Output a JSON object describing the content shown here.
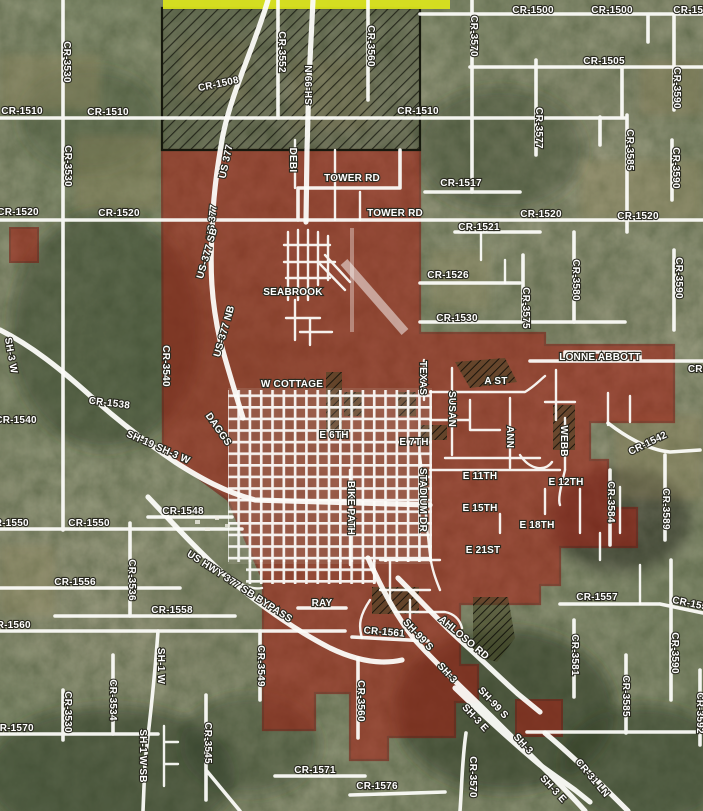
{
  "map": {
    "colors": {
      "road": "#fdfdfa",
      "city_fill": "#a51a10",
      "city_border": "#7c130c",
      "hatch": "#16180d",
      "annex_yellow": "#d9e31d",
      "label_fill": "#ffffff",
      "label_halo": "#2a2a20"
    },
    "road_labels": [
      {
        "text": "CR-1500",
        "x": 533,
        "y": 13
      },
      {
        "text": "CR-1500",
        "x": 612,
        "y": 13
      },
      {
        "text": "CR-1500",
        "x": 694,
        "y": 13
      },
      {
        "text": "CR-1505",
        "x": 604,
        "y": 64
      },
      {
        "text": "CR-1510",
        "x": 22,
        "y": 114
      },
      {
        "text": "CR-1510",
        "x": 108,
        "y": 115
      },
      {
        "text": "CR-1510",
        "x": 418,
        "y": 114
      },
      {
        "text": "CR-1508",
        "x": 219,
        "y": 87,
        "r": -12
      },
      {
        "text": "CR-3530",
        "x": 64,
        "y": 62,
        "r": 90
      },
      {
        "text": "CR-3530",
        "x": 65,
        "y": 166,
        "r": 90
      },
      {
        "text": "CR-3552",
        "x": 279,
        "y": 52,
        "r": 90
      },
      {
        "text": "SH-99 N",
        "x": 312,
        "y": 85,
        "r": -90
      },
      {
        "text": "US 377",
        "x": 229,
        "y": 162,
        "r": -78
      },
      {
        "text": "US 377",
        "x": 215,
        "y": 222,
        "r": -84
      },
      {
        "text": "DEBI",
        "x": 290,
        "y": 160,
        "r": 90
      },
      {
        "text": "CR-3560",
        "x": 368,
        "y": 46,
        "r": 90
      },
      {
        "text": "CR-3570",
        "x": 471,
        "y": 36,
        "r": 90
      },
      {
        "text": "CR-3577",
        "x": 536,
        "y": 128,
        "r": 90
      },
      {
        "text": "CR-3585",
        "x": 627,
        "y": 150,
        "r": 90
      },
      {
        "text": "CR-3590",
        "x": 674,
        "y": 88,
        "r": 90
      },
      {
        "text": "CR-3590",
        "x": 673,
        "y": 168,
        "r": 90
      },
      {
        "text": "CR-1517",
        "x": 461,
        "y": 186
      },
      {
        "text": "TOWER RD",
        "x": 352,
        "y": 181
      },
      {
        "text": "TOWER RD",
        "x": 395,
        "y": 216
      },
      {
        "text": "CR-1520",
        "x": 18,
        "y": 215
      },
      {
        "text": "CR-1520",
        "x": 119,
        "y": 216
      },
      {
        "text": "CR-1520",
        "x": 541,
        "y": 217
      },
      {
        "text": "CR-1520",
        "x": 638,
        "y": 219
      },
      {
        "text": "CR-1521",
        "x": 479,
        "y": 230
      },
      {
        "text": "CR-1526",
        "x": 448,
        "y": 278
      },
      {
        "text": "CR-1530",
        "x": 457,
        "y": 321
      },
      {
        "text": "CR-3575",
        "x": 523,
        "y": 308,
        "r": 90
      },
      {
        "text": "CR-3580",
        "x": 573,
        "y": 280,
        "r": 90
      },
      {
        "text": "CR-3590",
        "x": 676,
        "y": 278,
        "r": 90
      },
      {
        "text": "US-377 SB",
        "x": 210,
        "y": 254,
        "r": -74
      },
      {
        "text": "US-377 NB",
        "x": 227,
        "y": 332,
        "r": -74
      },
      {
        "text": "SEABROOK",
        "x": 293,
        "y": 295,
        "s": 10.5
      },
      {
        "text": "SH-3 W",
        "x": 8,
        "y": 356,
        "r": 80
      },
      {
        "text": "CR-3540",
        "x": 163,
        "y": 366,
        "r": 90
      },
      {
        "text": "CR-1538",
        "x": 109,
        "y": 406,
        "r": 7
      },
      {
        "text": "CR-1540",
        "x": 16,
        "y": 423
      },
      {
        "text": "SH-19 SH-3 W",
        "x": 157,
        "y": 450,
        "r": 24
      },
      {
        "text": "DAGGS",
        "x": 216,
        "y": 431,
        "r": 55
      },
      {
        "text": "W COTTAGE",
        "x": 292,
        "y": 387
      },
      {
        "text": "LONNE ABBOTT",
        "x": 600,
        "y": 360,
        "s": 10.5
      },
      {
        "text": "CR-",
        "x": 697,
        "y": 372
      },
      {
        "text": "TEXAS",
        "x": 420,
        "y": 378,
        "r": 90
      },
      {
        "text": "SUSAN",
        "x": 449,
        "y": 409,
        "r": 90
      },
      {
        "text": "A ST",
        "x": 496,
        "y": 384
      },
      {
        "text": "ANN",
        "x": 507,
        "y": 437,
        "r": 90
      },
      {
        "text": "WEBB",
        "x": 561,
        "y": 441,
        "r": 90
      },
      {
        "text": "E 6TH",
        "x": 334,
        "y": 438
      },
      {
        "text": "E 7TH",
        "x": 414,
        "y": 445
      },
      {
        "text": "BIKE PATH",
        "x": 348,
        "y": 508,
        "r": 90
      },
      {
        "text": "STADIUM DR",
        "x": 420,
        "y": 500,
        "r": 90
      },
      {
        "text": "E 11TH",
        "x": 480,
        "y": 479
      },
      {
        "text": "E 12TH",
        "x": 566,
        "y": 485
      },
      {
        "text": "E 15TH",
        "x": 480,
        "y": 511
      },
      {
        "text": "E 18TH",
        "x": 537,
        "y": 528
      },
      {
        "text": "E 21ST",
        "x": 483,
        "y": 553
      },
      {
        "text": "CR-1542",
        "x": 649,
        "y": 446,
        "r": -26
      },
      {
        "text": "CR-3584",
        "x": 608,
        "y": 502,
        "r": 90
      },
      {
        "text": "CR-3589",
        "x": 663,
        "y": 509,
        "r": 90
      },
      {
        "text": "CR-1557",
        "x": 597,
        "y": 600
      },
      {
        "text": "CR-1557",
        "x": 692,
        "y": 607,
        "r": 12
      },
      {
        "text": "RAY",
        "x": 322,
        "y": 606
      },
      {
        "text": "CR-1548",
        "x": 183,
        "y": 514
      },
      {
        "text": "CR-1550",
        "x": 8,
        "y": 526
      },
      {
        "text": "CR-1550",
        "x": 89,
        "y": 526
      },
      {
        "text": "CR-1556",
        "x": 75,
        "y": 585
      },
      {
        "text": "CR-3536",
        "x": 129,
        "y": 580,
        "r": 90
      },
      {
        "text": "CR-1558",
        "x": 172,
        "y": 613
      },
      {
        "text": "CR-1560",
        "x": 10,
        "y": 628
      },
      {
        "text": "US HWY 377 SB BYPASS",
        "x": 238,
        "y": 589,
        "r": 33
      },
      {
        "text": "CR-3549",
        "x": 258,
        "y": 666,
        "r": 90
      },
      {
        "text": "SH-1 W",
        "x": 158,
        "y": 666,
        "r": 90
      },
      {
        "text": "SH-1 W SB",
        "x": 140,
        "y": 756,
        "r": 90
      },
      {
        "text": "CR-3534",
        "x": 110,
        "y": 700,
        "r": 90
      },
      {
        "text": "CR-3530",
        "x": 65,
        "y": 712,
        "r": 90
      },
      {
        "text": "CR-1570",
        "x": 13,
        "y": 731
      },
      {
        "text": "CR-3545",
        "x": 205,
        "y": 743,
        "r": 90
      },
      {
        "text": "CR-1571",
        "x": 315,
        "y": 773
      },
      {
        "text": "CR-1561",
        "x": 384,
        "y": 635,
        "r": 5
      },
      {
        "text": "AHLOSO RD",
        "x": 462,
        "y": 640,
        "r": 40
      },
      {
        "text": "CR-3560",
        "x": 358,
        "y": 701,
        "r": 90
      },
      {
        "text": "CR-3570",
        "x": 470,
        "y": 777,
        "r": 90
      },
      {
        "text": "SH-99 S",
        "x": 416,
        "y": 637,
        "r": 47
      },
      {
        "text": "SH-99 S",
        "x": 491,
        "y": 705,
        "r": 47
      },
      {
        "text": "SH-3",
        "x": 445,
        "y": 675,
        "r": 47
      },
      {
        "text": "SH-3",
        "x": 521,
        "y": 746,
        "r": 47
      },
      {
        "text": "SH-3 E",
        "x": 473,
        "y": 720,
        "r": 47
      },
      {
        "text": "SH-3 E",
        "x": 551,
        "y": 791,
        "r": 47
      },
      {
        "text": "CR-31 LN",
        "x": 590,
        "y": 780,
        "r": 50
      },
      {
        "text": "CR-3581",
        "x": 572,
        "y": 655,
        "r": 90
      },
      {
        "text": "CR-3585",
        "x": 623,
        "y": 696,
        "r": 90
      },
      {
        "text": "CR-3590",
        "x": 672,
        "y": 653,
        "r": 90
      },
      {
        "text": "CR-3592",
        "x": 697,
        "y": 713,
        "r": 90
      },
      {
        "text": "CR-1576",
        "x": 377,
        "y": 789
      }
    ]
  }
}
